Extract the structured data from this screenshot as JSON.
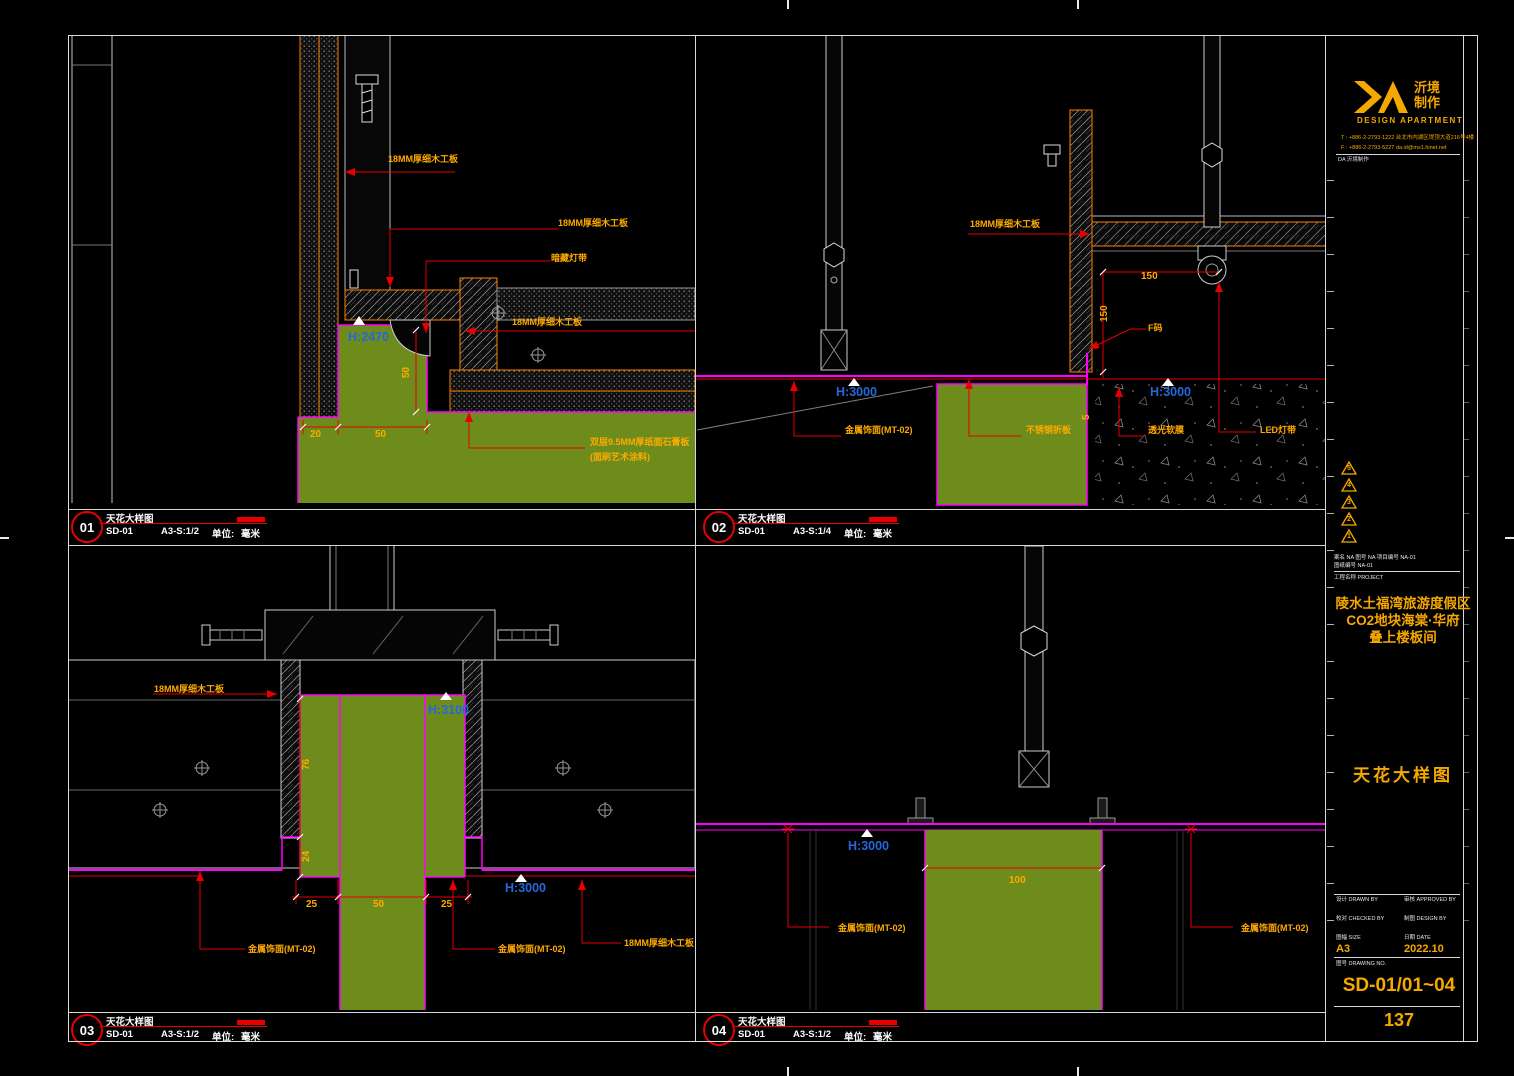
{
  "panels": [
    {
      "num": "01",
      "title": "天花大样图",
      "code": "SD-01",
      "scale": "A3-S:1/2",
      "unit_label": "单位:",
      "unit": "毫米"
    },
    {
      "num": "02",
      "title": "天花大样图",
      "code": "SD-01",
      "scale": "A3-S:1/4",
      "unit_label": "单位:",
      "unit": "毫米"
    },
    {
      "num": "03",
      "title": "天花大样图",
      "code": "SD-01",
      "scale": "A3-S:1/2",
      "unit_label": "单位:",
      "unit": "毫米"
    },
    {
      "num": "04",
      "title": "天花大样图",
      "code": "SD-01",
      "scale": "A3-S:1/2",
      "unit_label": "单位:",
      "unit": "毫米"
    }
  ],
  "p1": {
    "plywood_top": "18MM厚细木工板",
    "plywood_mid": "18MM厚细木工板",
    "light": "暗藏灯带",
    "plywood_right": "18MM厚细木工板",
    "gypsum1": "双层9.5MM厚纸面石膏板",
    "gypsum2": "(面刷艺术涂料)",
    "height": "H:2470",
    "dim20": "20",
    "dim50": "50",
    "dim50v": "50"
  },
  "p2": {
    "plywood": "18MM厚细木工板",
    "dim150h": "150",
    "dim150v": "150",
    "dim5": "5",
    "fcode": "F码",
    "height_left": "H:3000",
    "height_right": "H:3000",
    "metal": "金属饰面(MT-02)",
    "steel": "不锈钢折板",
    "membrane": "透光软膜",
    "led": "LED灯带"
  },
  "p3": {
    "plywood_top": "18MM厚细木工板",
    "height_top": "H:3100",
    "height_bottom": "H:3000",
    "dim76": "76",
    "dim24": "24",
    "dim25a": "25",
    "dim50": "50",
    "dim25b": "25",
    "metal_a": "金属饰面(MT-02)",
    "metal_b": "金属饰面(MT-02)",
    "plywood_bottom": "18MM厚细木工板"
  },
  "p4": {
    "height": "H:3000",
    "dim100": "100",
    "metal_a": "金属饰面(MT-02)",
    "metal_b": "金属饰面(MT-02)"
  },
  "titleblock": {
    "brand_cn_top": "沂境",
    "brand_cn_bottom": "制作",
    "brand_en": "DESIGN APARTMENT",
    "tel": "T : +886-2-2793-1222  台北市内湖区堤顶大道216号4楼",
    "fax": "F : +886-2-2793-5227  da.id@ms1.hinet.net",
    "stamp": "DA 沂境制作",
    "revisions": [
      "5",
      "4",
      "3",
      "2",
      "1"
    ],
    "info_row1": "案名 NA    图号 NA    项目编号 NA-01",
    "info_row2": "图纸编号 NA-01",
    "info_row3": "工程名称 PROJECT",
    "project_line1": "陵水土福湾旅游度假区",
    "project_line2": "CO2地块海棠·华府",
    "project_line3": "叠上楼板间",
    "drawing_title": "天花大样图",
    "row1_left": "设计 DRAWN BY",
    "row1_right": "审核 APPROVED BY",
    "row2_left": "校对 CHECKED BY",
    "row2_right": "制图 DESIGN BY",
    "row3_left": "图幅 SIZE",
    "row3_right": "日期 DATE",
    "size_value": "A3",
    "date_value": "2022.10",
    "sheetno_label": "图号 DRAWING NO.",
    "sheet_no": "SD-01/01~04",
    "page_no": "137"
  },
  "colors": {
    "accent_yellow": "#ffaa00",
    "accent_red": "#e60000",
    "magenta": "#ff00ff",
    "green": "#6e8c1b",
    "blue": "#2767d9",
    "orange": "#ff7f00"
  }
}
